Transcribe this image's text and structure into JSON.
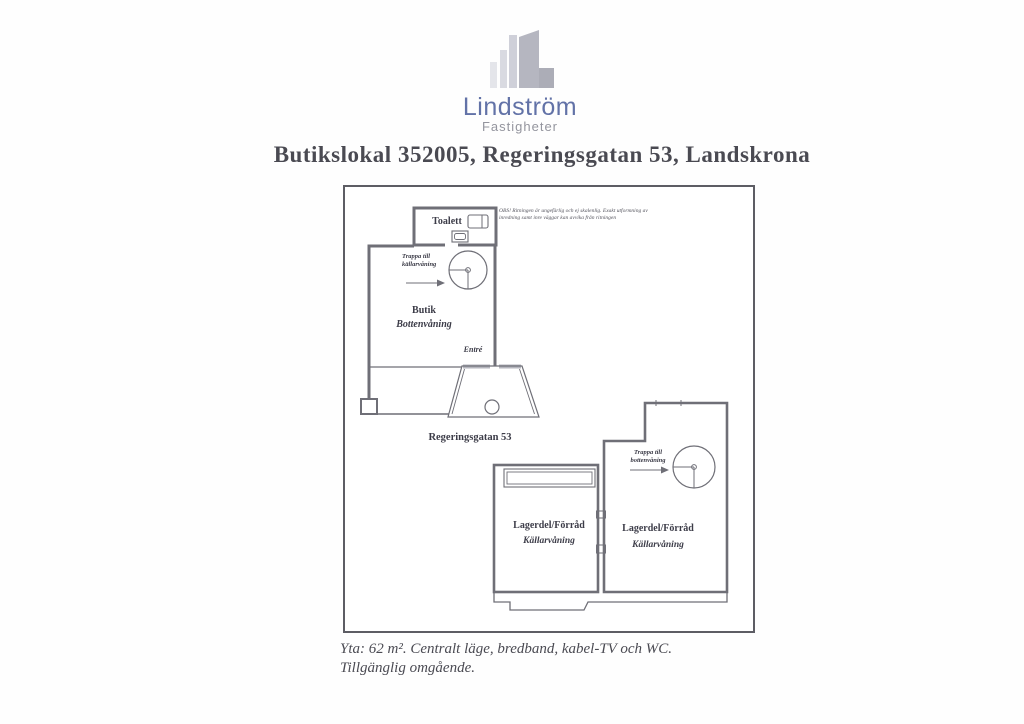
{
  "document": {
    "logo": {
      "name": "Lindström",
      "subtitle": "Fastigheter"
    },
    "title": "Butikslokal 352005, Regeringsgatan 53, Landskrona",
    "footer": {
      "line1": "Yta: 62 m². Centralt läge, bredband, kabel-TV och WC.",
      "line2": "Tillgänglig omgående."
    }
  },
  "plan": {
    "disclaimer": {
      "line1": "OBS! Ritningen är ungefärlig och ej skalenlig. Exakt utformning av",
      "line2": "inredning samt inre väggar kan avvika från ritningen"
    },
    "ground_floor": {
      "toilet": "Toalett",
      "stairs_line1": "Trappa till",
      "stairs_line2": "källarvåning",
      "room": "Butik",
      "level": "Bottenvåning",
      "entrance": "Entré",
      "street": "Regeringsgatan 53"
    },
    "basement": {
      "stairs_line1": "Trappa till",
      "stairs_line2": "bottenvåning",
      "left_room": {
        "name": "Lagerdel/Förråd",
        "level": "Källarvåning"
      },
      "right_room": {
        "name": "Lagerdel/Förråd",
        "level": "Källarvåning"
      }
    }
  },
  "colors": {
    "plan_line": "#6f6f77",
    "plan_text": "#3c3c48",
    "title_text": "#4a4a52",
    "logo_name": "#6272a7",
    "logo_subtitle": "#94959e",
    "glazing_gray": "#b5b6be",
    "building_icon_dark": "#b5b6c0",
    "building_icon_light": "#dcdde4"
  }
}
